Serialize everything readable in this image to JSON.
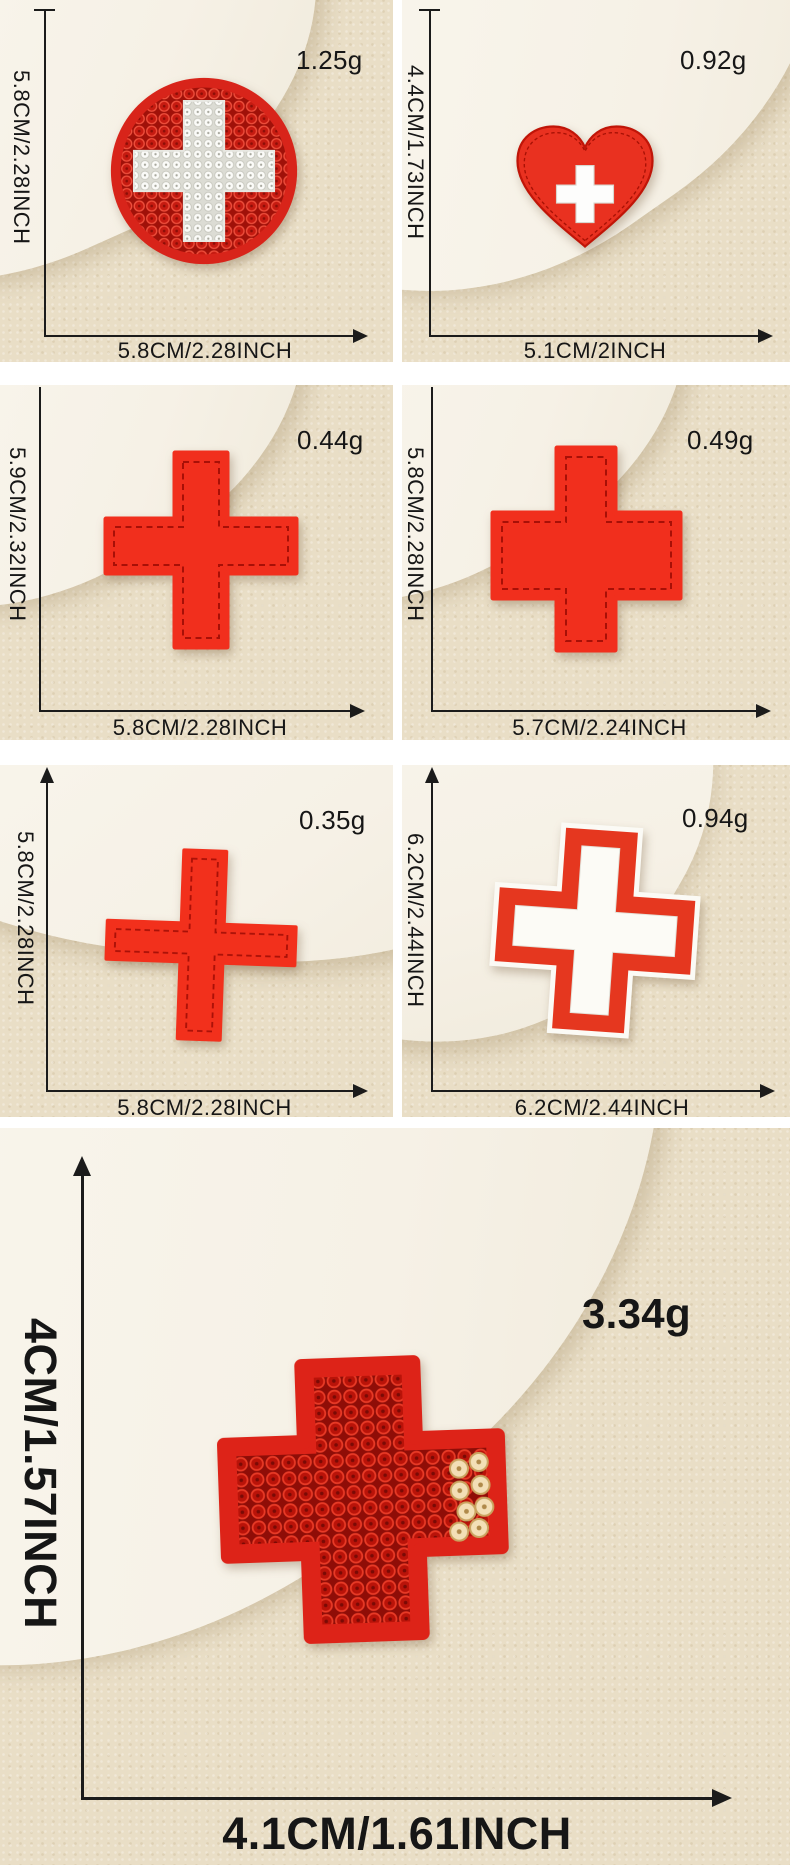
{
  "product": "red cross embroidered and sequin patches size chart",
  "colors": {
    "backdrop_beige": "#e9dec6",
    "backdrop_white_fabric": "#f8f4ea",
    "patch_red": "#f12f1d",
    "patch_felt_red": "#dd2318",
    "sequin_dark_red": "#b91309",
    "sequin_silver": "#f3dfb6",
    "cross_white": "#fcfbf7",
    "annotation_text": "#161616"
  },
  "panels": [
    {
      "patch": "round-sequin-patch-with-white-cross",
      "weight": "1.25g",
      "vertical_dimension": "5.8CM/2.28INCH",
      "horizontal_dimension": "5.8CM/2.28INCH"
    },
    {
      "patch": "red-heart-patch-with-white-cross",
      "weight": "0.92g",
      "vertical_dimension": "4.4CM/1.73INCH",
      "horizontal_dimension": "5.1CM/2INCH"
    },
    {
      "patch": "red-fabric-cross-patch-stitched",
      "weight": "0.44g",
      "vertical_dimension": "5.9CM/2.32INCH",
      "horizontal_dimension": "5.8CM/2.28INCH"
    },
    {
      "patch": "red-fabric-cross-patch-stitched-wide",
      "weight": "0.49g",
      "vertical_dimension": "5.8CM/2.28INCH",
      "horizontal_dimension": "5.7CM/2.24INCH"
    },
    {
      "patch": "thin-red-cross-patch",
      "weight": "0.35g",
      "vertical_dimension": "5.8CM/2.28INCH",
      "horizontal_dimension": "5.8CM/2.28INCH"
    },
    {
      "patch": "white-cross-patch-red-border",
      "weight": "0.94g",
      "vertical_dimension": "6.2CM/2.44INCH",
      "horizontal_dimension": "6.2CM/2.44INCH"
    }
  ],
  "large_panel": {
    "patch": "large-red-sequin-cross-patch",
    "weight": "3.34g",
    "vertical_dimension": "4CM/1.57INCH",
    "horizontal_dimension": "4.1CM/1.61INCH"
  }
}
